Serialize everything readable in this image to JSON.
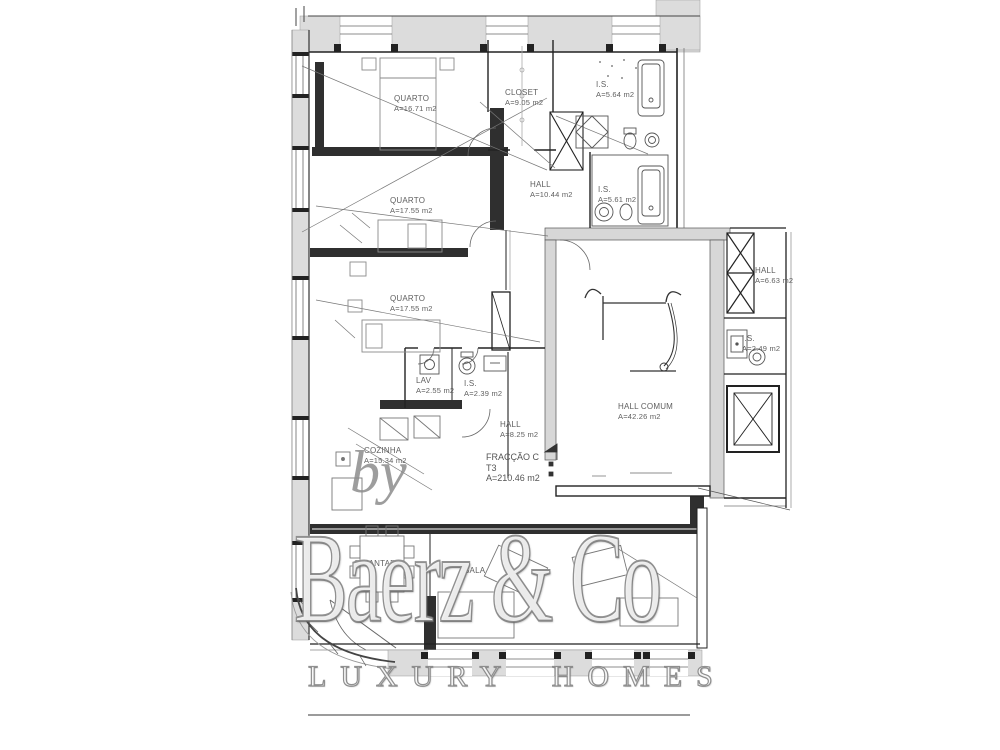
{
  "watermark": {
    "by": "by",
    "brand": "Baerz & Co",
    "tagline": "LUXURY HOMES"
  },
  "plan": {
    "title": {
      "fraction": "FRACÇÃO C",
      "type": "T3",
      "area": "A=210.46 m2"
    },
    "rooms": [
      {
        "id": "quarto-1",
        "label": "QUARTO",
        "area": "A=16.71 m2",
        "x": 394,
        "y": 94
      },
      {
        "id": "closet",
        "label": "CLOSET",
        "area": "A=9.05 m2",
        "x": 505,
        "y": 88
      },
      {
        "id": "is-1",
        "label": "I.S.",
        "area": "A=5.64 m2",
        "x": 596,
        "y": 80
      },
      {
        "id": "hall-1",
        "label": "HALL",
        "area": "A=10.44 m2",
        "x": 530,
        "y": 180
      },
      {
        "id": "is-2",
        "label": "I.S.",
        "area": "A=5.61 m2",
        "x": 598,
        "y": 185
      },
      {
        "id": "quarto-2",
        "label": "QUARTO",
        "area": "A=17.55 m2",
        "x": 390,
        "y": 196
      },
      {
        "id": "quarto-3",
        "label": "QUARTO",
        "area": "A=17.55 m2",
        "x": 390,
        "y": 294
      },
      {
        "id": "hall-2",
        "label": "HALL",
        "area": "A=6.63 m2",
        "x": 755,
        "y": 266
      },
      {
        "id": "is-3",
        "label": "I.S.",
        "area": "A=2.49 m2",
        "x": 742,
        "y": 334
      },
      {
        "id": "lav",
        "label": "LAV",
        "area": "A=2.55 m2",
        "x": 416,
        "y": 376
      },
      {
        "id": "is-4",
        "label": "I.S.",
        "area": "A=2.39 m2",
        "x": 464,
        "y": 379
      },
      {
        "id": "hall-3",
        "label": "HALL",
        "area": "A=8.25 m2",
        "x": 500,
        "y": 420
      },
      {
        "id": "hall-comum",
        "label": "HALL COMUM",
        "area": "A=42.26 m2",
        "x": 618,
        "y": 402
      },
      {
        "id": "cozinha",
        "label": "COZINHA",
        "area": "A=15.34 m2",
        "x": 364,
        "y": 446
      },
      {
        "id": "s-jantar",
        "label": "S. JANTAR",
        "area": "",
        "x": 354,
        "y": 559
      },
      {
        "id": "sala",
        "label": "SALA",
        "area": "",
        "x": 464,
        "y": 566
      }
    ]
  },
  "colors": {
    "wall_fill": "#dcdcdc",
    "wall_heavy": "#2f2f2f",
    "line": "#222222",
    "label_text": "#5f5f5f",
    "watermark_gray": "#8e8e8e"
  }
}
